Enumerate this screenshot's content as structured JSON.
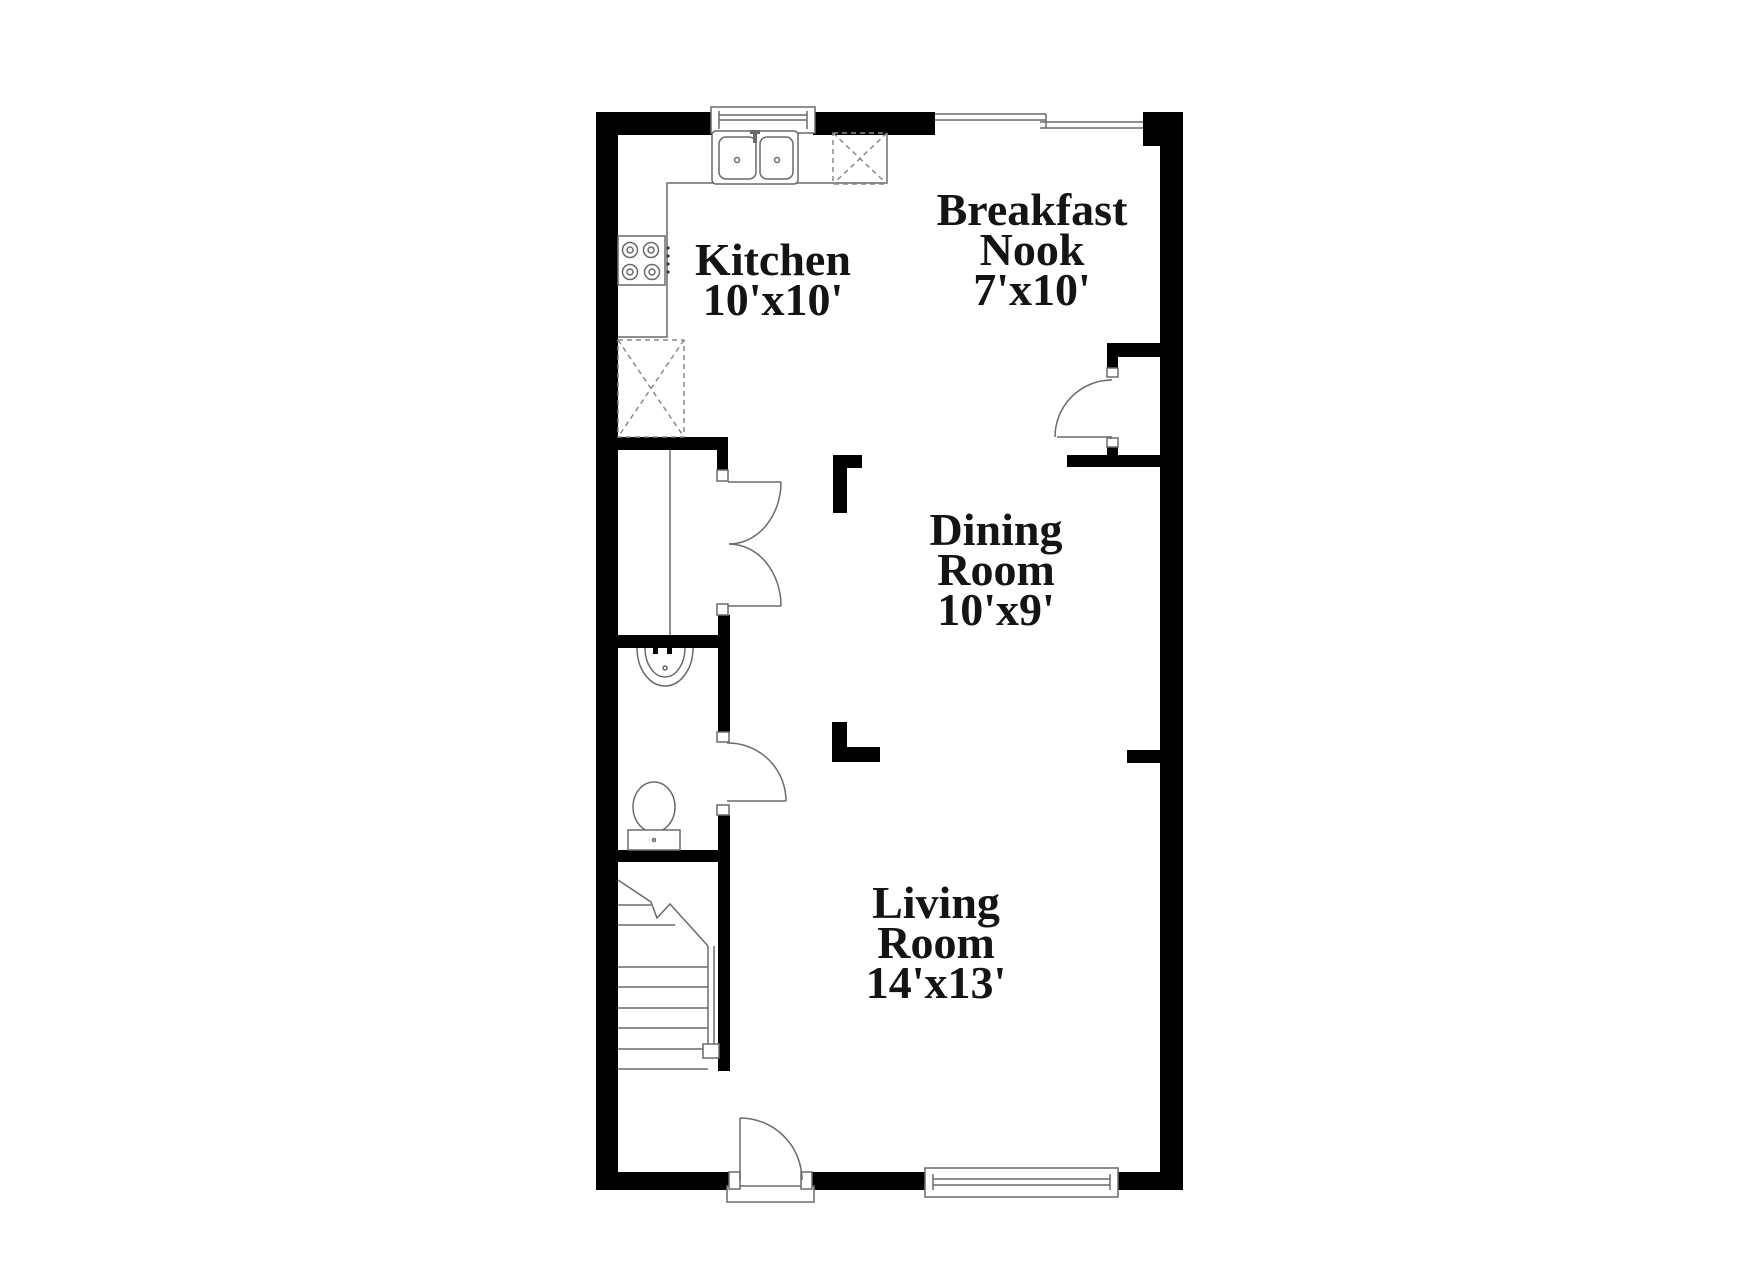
{
  "document": {
    "type": "floor-plan",
    "background_color": "#ffffff",
    "wall_color": "#000000",
    "fixture_line_color": "#6a6a6a",
    "text_color": "#141414"
  },
  "rooms": [
    {
      "id": "kitchen",
      "lines": [
        "Kitchen",
        "10'x10'"
      ]
    },
    {
      "id": "breakfast-nook",
      "lines": [
        "Breakfast",
        "Nook",
        "7'x10'"
      ]
    },
    {
      "id": "dining-room",
      "lines": [
        "Dining",
        "Room",
        "10'x9'"
      ]
    },
    {
      "id": "living-room",
      "lines": [
        "Living",
        "Room",
        "14'x13'"
      ]
    }
  ],
  "fixtures": [
    "double-basin-kitchen-sink-icon",
    "cooktop-four-burner-icon",
    "dishwasher-dashed-x-icon",
    "refrigerator-dashed-x-icon",
    "powder-room-sink-icon",
    "toilet-icon",
    "staircase-with-break-line-icon",
    "entry-door-swing-icon",
    "closet-double-door-swing-icon",
    "nook-closet-door-swing-icon",
    "powder-door-swing-icon",
    "window-top-kitchen-icon",
    "window-top-nook-icon",
    "window-bottom-living-icon"
  ]
}
